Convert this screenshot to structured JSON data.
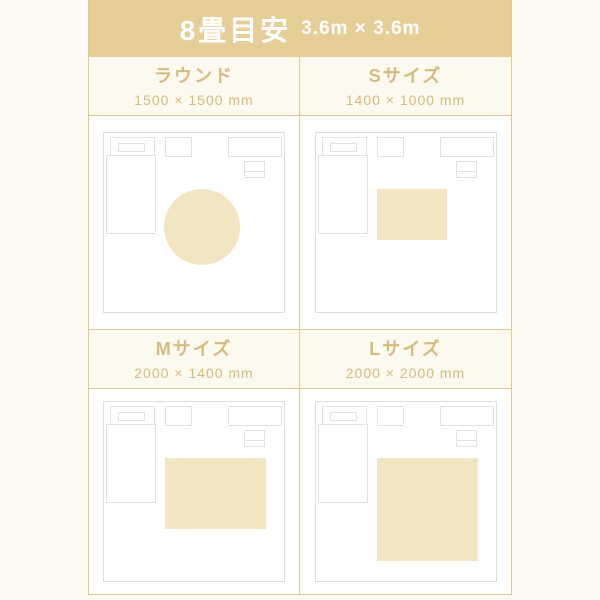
{
  "title": {
    "main": "8畳目安",
    "sub": "3.6m × 3.6m"
  },
  "colors": {
    "banner_bg": "#E5CF96",
    "banner_text": "#FFFFFF",
    "accent_text": "#D5BB80",
    "divider": "#DECA92",
    "rug_fill": "#F2E5C2",
    "room_outline": "#DEDEDE",
    "page_bg": "#FCFAF3",
    "cell_header_bg": "#FCF9EF"
  },
  "cells": [
    {
      "name": "ラウンド",
      "dimensions": "1500 × 1500 mm",
      "rug": {
        "shape": "circle",
        "left": 60,
        "top": 56,
        "w": 76,
        "h": 76
      }
    },
    {
      "name": "Sサイズ",
      "dimensions": "1400 × 1000 mm",
      "rug": {
        "shape": "rect",
        "left": 61,
        "top": 56,
        "w": 70,
        "h": 51
      }
    },
    {
      "name": "Mサイズ",
      "dimensions": "2000 × 1400 mm",
      "rug": {
        "shape": "rect",
        "left": 61,
        "top": 56,
        "w": 101,
        "h": 71
      }
    },
    {
      "name": "Lサイズ",
      "dimensions": "2000 × 2000 mm",
      "rug": {
        "shape": "rect",
        "left": 61,
        "top": 56,
        "w": 101,
        "h": 103
      }
    }
  ]
}
